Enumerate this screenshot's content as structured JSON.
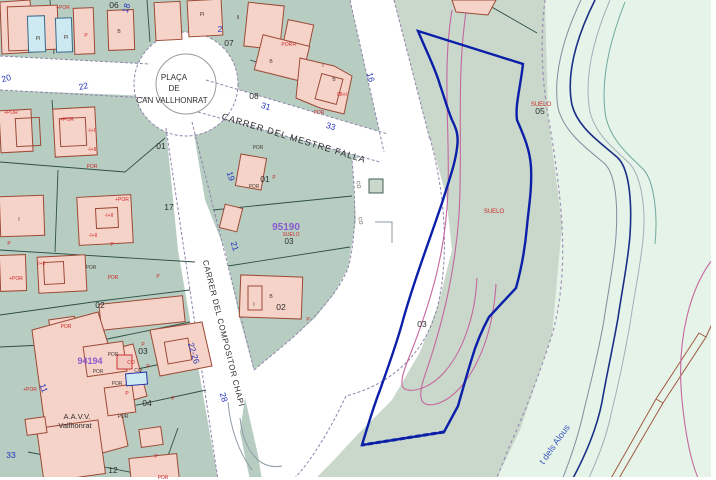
{
  "colors": {
    "urban_green": "#b7cdc2",
    "strip_green": "#c9d8ca",
    "open_green": "#e6f3e8",
    "road_white": "#ffffff",
    "building_pink": "#f6d3c8",
    "building_outline": "#9c4a36",
    "pool_blue": "#cde9f1",
    "parcel_line": "#2f4f45",
    "road_edge_purple": "#8f84aa",
    "subject_parcel_blue": "#0b1fa8",
    "street_number_blue": "#2233bb",
    "label_red": "#cc2a2a",
    "zone_purple": "#8a5acd",
    "contour_magenta": "#c4679f",
    "stream_navy": "#1a2f86",
    "brown_line": "#a05a40",
    "dark_text": "#2e2e2e"
  },
  "labels": {
    "streets": [
      {
        "text": "PLAÇA",
        "x": 174,
        "y": 80,
        "rot": 0,
        "size": 8
      },
      {
        "text": "DE",
        "x": 174,
        "y": 91,
        "rot": 0,
        "size": 8
      },
      {
        "text": "CAN VALLHONRAT",
        "x": 172,
        "y": 103,
        "rot": 0,
        "size": 8
      },
      {
        "text": "CARRER DEL MESTRE FALLA",
        "x": 293,
        "y": 141,
        "rot": 17,
        "size": 9,
        "spacing": 1
      },
      {
        "text": "CARRER DEL COMPOSITOR CHAPI",
        "x": 221,
        "y": 334,
        "rot": 76,
        "size": 8,
        "spacing": 0.6
      },
      {
        "text": "A.A.V.V.",
        "x": 77,
        "y": 419,
        "rot": 0,
        "size": 7.5
      },
      {
        "text": "Vallhonrat",
        "x": 75,
        "y": 428,
        "rot": 0,
        "size": 7.5
      }
    ],
    "stream": [
      {
        "text": "t dels Alous",
        "x": 557,
        "y": 446,
        "rot": -55,
        "size": 9
      }
    ],
    "street_numbers": [
      {
        "text": "20",
        "x": 7,
        "y": 81,
        "rot": -15
      },
      {
        "text": "22",
        "x": 84,
        "y": 89,
        "rot": -12
      },
      {
        "text": "18",
        "x": 129,
        "y": 9,
        "rot": -72
      },
      {
        "text": "2",
        "x": 220,
        "y": 32,
        "rot": 0
      },
      {
        "text": "31",
        "x": 265,
        "y": 109,
        "rot": 17
      },
      {
        "text": "33",
        "x": 330,
        "y": 129,
        "rot": 17
      },
      {
        "text": "16",
        "x": 368,
        "y": 78,
        "rot": 75
      },
      {
        "text": "19",
        "x": 228,
        "y": 177,
        "rot": 73
      },
      {
        "text": "21",
        "x": 232,
        "y": 247,
        "rot": 73
      },
      {
        "text": "22-26",
        "x": 191,
        "y": 354,
        "rot": 73
      },
      {
        "text": "28",
        "x": 221,
        "y": 398,
        "rot": 73
      },
      {
        "text": "33",
        "x": 11,
        "y": 458,
        "rot": 0
      },
      {
        "text": "11",
        "x": 41,
        "y": 389,
        "rot": 70
      }
    ],
    "parcel_numbers": [
      {
        "text": "06",
        "x": 114,
        "y": 8
      },
      {
        "text": "07",
        "x": 229,
        "y": 46
      },
      {
        "text": "08",
        "x": 254,
        "y": 99
      },
      {
        "text": "01",
        "x": 161,
        "y": 149
      },
      {
        "text": "01",
        "x": 265,
        "y": 182
      },
      {
        "text": "17",
        "x": 169,
        "y": 210
      },
      {
        "text": "02",
        "x": 100,
        "y": 308
      },
      {
        "text": "02",
        "x": 281,
        "y": 310
      },
      {
        "text": "03",
        "x": 143,
        "y": 354
      },
      {
        "text": "04",
        "x": 147,
        "y": 406
      },
      {
        "text": "12",
        "x": 113,
        "y": 473
      },
      {
        "text": "05",
        "x": 540,
        "y": 114
      },
      {
        "text": "03",
        "x": 422,
        "y": 327
      }
    ],
    "zones": [
      {
        "text": "95190",
        "x": 286,
        "y": 230,
        "color": "purple",
        "size": 10,
        "bold": true
      },
      {
        "text": "SUELO",
        "x": 291,
        "y": 236,
        "color": "red",
        "size": 5
      },
      {
        "text": "03",
        "x": 289,
        "y": 244,
        "color": "dark",
        "size": 8
      },
      {
        "text": "94194",
        "x": 90,
        "y": 364,
        "color": "purple",
        "size": 9,
        "bold": true
      },
      {
        "text": "SUELO",
        "x": 494,
        "y": 213,
        "color": "red",
        "size": 6
      },
      {
        "text": "SUELO",
        "x": 541,
        "y": 106,
        "color": "red",
        "size": 6
      }
    ],
    "buildings_red": [
      {
        "text": "+POR",
        "x": 63,
        "y": 9
      },
      {
        "text": "P",
        "x": 86,
        "y": 37
      },
      {
        "text": "POR+I",
        "x": 289,
        "y": 46
      },
      {
        "text": "08+I",
        "x": 342,
        "y": 96
      },
      {
        "text": "POR",
        "x": 319,
        "y": 114
      },
      {
        "text": "+POR",
        "x": 67,
        "y": 121
      },
      {
        "text": "-I+II",
        "x": 92,
        "y": 132
      },
      {
        "text": "-I+II",
        "x": 92,
        "y": 151
      },
      {
        "text": "+POR",
        "x": 11,
        "y": 114
      },
      {
        "text": "POR",
        "x": 92,
        "y": 168
      },
      {
        "text": "+POR",
        "x": 122,
        "y": 201
      },
      {
        "text": "-I+II",
        "x": 109,
        "y": 217
      },
      {
        "text": "-I+II",
        "x": 93,
        "y": 237
      },
      {
        "text": "P",
        "x": 112,
        "y": 246
      },
      {
        "text": "P",
        "x": 9,
        "y": 245
      },
      {
        "text": "-I+II",
        "x": 41,
        "y": 265
      },
      {
        "text": "POR",
        "x": 113,
        "y": 279
      },
      {
        "text": "+POR",
        "x": 16,
        "y": 280
      },
      {
        "text": "P",
        "x": 158,
        "y": 278
      },
      {
        "text": "P",
        "x": 274,
        "y": 179
      },
      {
        "text": "P",
        "x": 308,
        "y": 321
      },
      {
        "text": "POR",
        "x": 66,
        "y": 328
      },
      {
        "text": "CO",
        "x": 131,
        "y": 364
      },
      {
        "text": "P",
        "x": 148,
        "y": 368
      },
      {
        "text": "P",
        "x": 173,
        "y": 400
      },
      {
        "text": "P",
        "x": 127,
        "y": 395
      },
      {
        "text": "POR",
        "x": 163,
        "y": 479
      },
      {
        "text": "P",
        "x": 156,
        "y": 458
      },
      {
        "text": "+POR",
        "x": 30,
        "y": 391
      },
      {
        "text": "P",
        "x": 143,
        "y": 346
      }
    ],
    "buildings_dark": [
      {
        "text": "PI",
        "x": 38,
        "y": 40
      },
      {
        "text": "PI",
        "x": 66,
        "y": 39
      },
      {
        "text": "B",
        "x": 119,
        "y": 33
      },
      {
        "text": "PI",
        "x": 202,
        "y": 16
      },
      {
        "text": "II",
        "x": 238,
        "y": 19
      },
      {
        "text": "B",
        "x": 271,
        "y": 63
      },
      {
        "text": "I",
        "x": 323,
        "y": 67
      },
      {
        "text": "B",
        "x": 334,
        "y": 81
      },
      {
        "text": "POR",
        "x": 258,
        "y": 149
      },
      {
        "text": "I",
        "x": 19,
        "y": 221
      },
      {
        "text": "POR",
        "x": 91,
        "y": 269
      },
      {
        "text": "POR",
        "x": 254,
        "y": 188
      },
      {
        "text": "B",
        "x": 271,
        "y": 298
      },
      {
        "text": "I",
        "x": 254,
        "y": 306
      },
      {
        "text": "POR",
        "x": 113,
        "y": 356
      },
      {
        "text": "POR",
        "x": 98,
        "y": 373
      },
      {
        "text": "POR",
        "x": 117,
        "y": 385
      },
      {
        "text": "CO",
        "x": 138,
        "y": 372
      },
      {
        "text": "POR",
        "x": 123,
        "y": 418
      },
      {
        "text": "CO",
        "x": 357,
        "y": 185,
        "rot": 80
      },
      {
        "text": "CO",
        "x": 359,
        "y": 221,
        "rot": 80
      }
    ]
  }
}
